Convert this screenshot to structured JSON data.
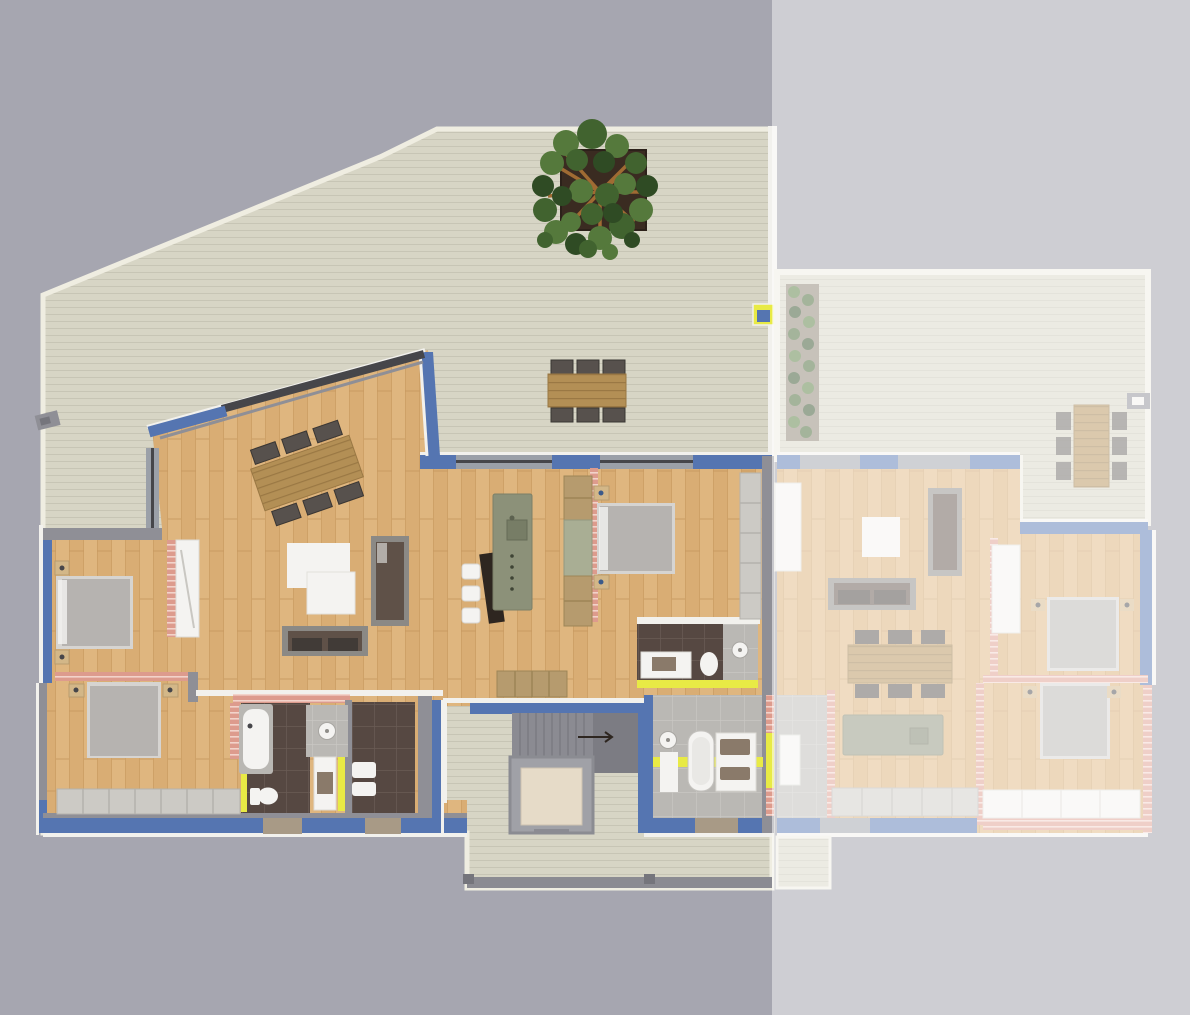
{
  "meta": {
    "kind": "floor-plan-rendering",
    "view": "top-down",
    "text_content": "none"
  },
  "render": {
    "canvas_width": 1190,
    "canvas_height": 1015,
    "faded_overlay_opacity": 0.52
  },
  "palette": {
    "bg_left": "#a6a6b0",
    "bg_right": "#9a9aa4",
    "deck": "#d7d5c5",
    "deck_line": "#c7c5b5",
    "deck_trim": "#efede1",
    "wood": "#d9ad74",
    "wood_light": "#e3bd89",
    "wood_dark": "#c79a5f",
    "wall_blue": "#5575b1",
    "wall_gray": "#8f8f96",
    "wall_gray_dark": "#75757c",
    "wall_white": "#f2f1ed",
    "window_gray": "#9ba0a8",
    "window_bay": "#a89a86",
    "glazing": "#46464a",
    "door_yellow": "#e8ea45",
    "brick_pink": "#dd9b8d",
    "brick_pink_light": "#f2d3ca",
    "bath_dark": "#564842",
    "bath_dark_line": "#6a5c55",
    "bath_light": "#bab8b4",
    "bath_light_line": "#c9c7c3",
    "stairs": "#8b8b92",
    "stairs_dark": "#7c7c83",
    "elevator_frame": "#a0a1a7",
    "elevator_floor": "#e6dbc8",
    "island_green": "#8c9179",
    "pantry_green": "#a9ae94",
    "counter_dark": "#2e2620",
    "table_wood": "#b38f55",
    "table_wood_line": "#9a7844",
    "chair": "#57514d",
    "chair_dark": "#3a3633",
    "bed": "#b6b3b0",
    "bed_frame": "#d6d4d1",
    "nightstand": "#d3b788",
    "sofa": "#5f5148",
    "sofa_frame": "#8b8985",
    "white_furniture": "#f4f3f1",
    "cabinet_gray": "#cccac5",
    "cabinet_wood": "#b69b6e",
    "sink_brown": "#8a7a6a",
    "tub_surround": "#b9b7b3",
    "tree_green_1": "#41632f",
    "tree_green_2": "#55793c",
    "tree_green_3": "#2f4b24",
    "planter": "#3a2b21",
    "branch": "#a06b33",
    "hedge_bg": "#8a8070"
  },
  "scene": {
    "terrace": [
      "main-deck",
      "tree-planter",
      "outdoor-dining-set",
      "skylight-hatch",
      "deck-gate-handle",
      "entry-deck",
      "staircase",
      "elevator"
    ],
    "unit_a_rooms": [
      "living-room",
      "kitchen",
      "bedroom-left-top",
      "bedroom-left-bottom",
      "bedroom-middle",
      "bathroom-dark-1",
      "bathroom-dark-2",
      "ensuite-bathroom",
      "main-bathroom"
    ],
    "unit_a_furniture": [
      "dining-table-6-chairs",
      "coffee-tables",
      "sofa-vertical",
      "sofa-horizontal",
      "tv-counter",
      "bar-stools",
      "kitchen-island",
      "tall-cabinet",
      "sideboard-cabinets",
      "beds",
      "nightstands",
      "wardrobes",
      "bathtub",
      "toilets",
      "showers",
      "vanities"
    ],
    "unit_b_faded": [
      "deck",
      "hedge",
      "outdoor-dining-set",
      "living-room",
      "dining-table",
      "kitchen-island",
      "sofas",
      "coffee-table",
      "bedroom-top",
      "bedroom-bottom",
      "wardrobes",
      "beds"
    ]
  }
}
